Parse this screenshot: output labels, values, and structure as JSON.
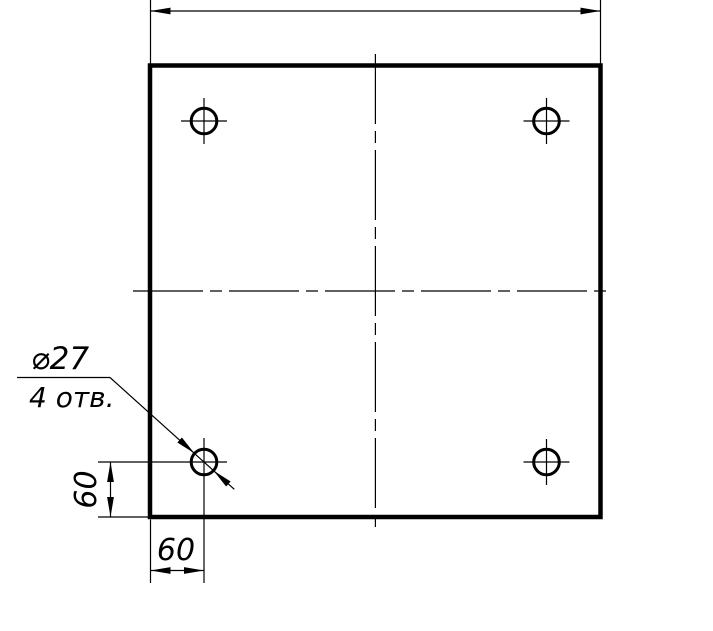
{
  "drawing": {
    "background_color": "#ffffff",
    "line_color": "#000000",
    "callout": {
      "diameter_label": "⌀27",
      "holes_count_label": "4 отв."
    },
    "dimensions": {
      "top_overall": "",
      "hole_offset_vertical": "60",
      "hole_offset_horizontal": "60"
    }
  }
}
